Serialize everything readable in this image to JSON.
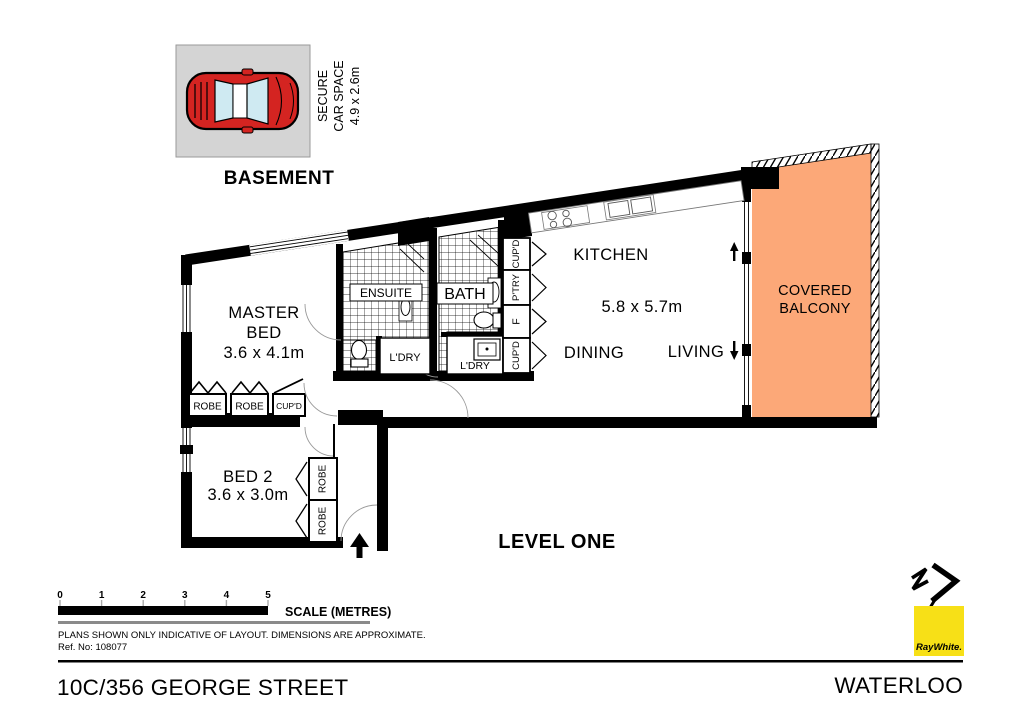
{
  "plan": {
    "basement_label": "BASEMENT",
    "level_label": "LEVEL ONE",
    "car_space": {
      "line1": "SECURE",
      "line2": "CAR SPACE",
      "line3": "4.9 x 2.6m"
    },
    "rooms": {
      "master_line1": "MASTER",
      "master_line2": "BED",
      "master_dims": "3.6 x 4.1m",
      "ensuite": "ENSUITE",
      "bath": "BATH",
      "ldry_left": "L'DRY",
      "ldry_right": "L'DRY",
      "kitchen": "KITCHEN",
      "living_dims": "5.8 x 5.7m",
      "dining": "DINING",
      "living": "LIVING",
      "balcony_line1": "COVERED",
      "balcony_line2": "BALCONY",
      "bed2_line1": "BED 2",
      "bed2_dims": "3.6 x 3.0m"
    },
    "storage": {
      "robe_row_1": "ROBE",
      "robe_row_2": "ROBE",
      "cupd_row": "CUP'D",
      "closet_col": [
        "CUP'D",
        "P'TRY",
        "F",
        "CUP'D"
      ],
      "robe_v_1": "ROBE",
      "robe_v_2": "ROBE"
    }
  },
  "scale_bar": {
    "ticks": [
      "0",
      "1",
      "2",
      "3",
      "4",
      "5"
    ],
    "label": "SCALE (METRES)"
  },
  "notes": {
    "disclaimer": "PLANS SHOWN ONLY INDICATIVE OF LAYOUT.  DIMENSIONS ARE APPROXIMATE.",
    "ref_no": "Ref. No: 108077"
  },
  "footer": {
    "address": "10C/356 GEORGE STREET",
    "suburb": "WATERLOO",
    "brand": "RayWhite."
  },
  "colors": {
    "balcony": "#FCA878",
    "car_body": "#D42421",
    "car_glass": "#CFEAF2",
    "car_space_bg": "#D4D4D4",
    "brand_yellow": "#F7E017"
  }
}
